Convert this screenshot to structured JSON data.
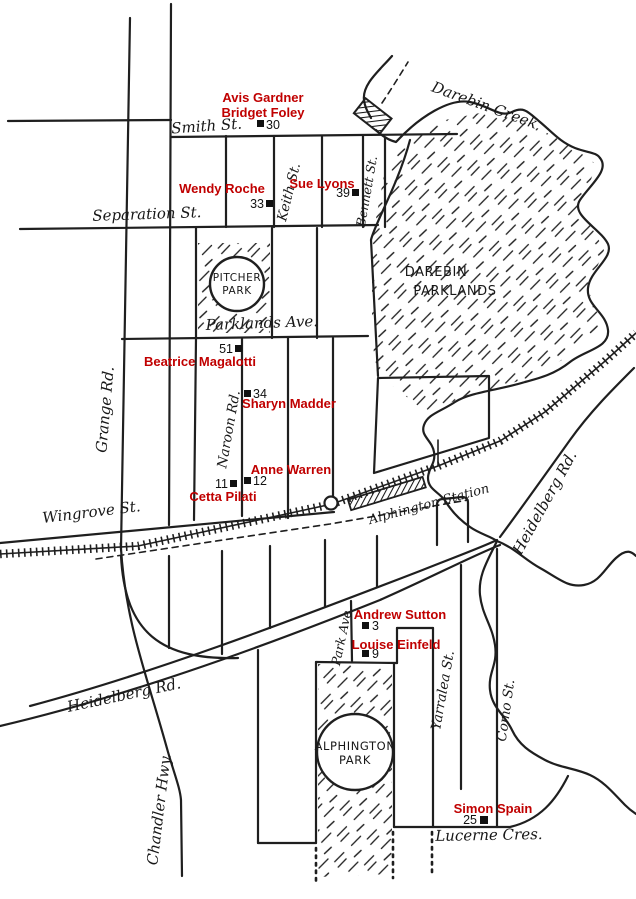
{
  "map_type": "hand-drawn street map",
  "colors": {
    "paper": "#ffffff",
    "ink": "#1f1f1f",
    "resident_label": "#c00000"
  },
  "creek_label": "Darebin Creek",
  "station_label": "Alphington Station",
  "streets": {
    "smith": "Smith St.",
    "separation": "Separation St.",
    "parklands_ave": "Parklands Ave.",
    "wingrove": "Wingrove St.",
    "grange": "Grange Rd.",
    "keith": "Keith St.",
    "bennett": "Bennett St.",
    "naroon": "Naroon Rd.",
    "heidelberg_right": "Heidelberg Rd.",
    "heidelberg_left": "Heidelberg Rd.",
    "chandler": "Chandler Hwy.",
    "park_ave": "Park Ave.",
    "yarralea": "Yarralea St.",
    "como": "Como St.",
    "lucerne": "Lucerne Cres."
  },
  "parks": {
    "pitcher": {
      "line1": "PITCHER",
      "line2": "PARK"
    },
    "darebin": {
      "line1": "DAREBIN",
      "line2": "PARKLANDS"
    },
    "alphington": {
      "line1": "ALPHINGTON",
      "line2": "PARK"
    }
  },
  "residents": [
    {
      "name": "Avis Gardner",
      "number": ""
    },
    {
      "name": "Bridget Foley",
      "number": "30"
    },
    {
      "name": "Wendy Roche",
      "number": "33"
    },
    {
      "name": "Sue Lyons",
      "number": "39"
    },
    {
      "name": "Beatrice Magalotti",
      "number": "51"
    },
    {
      "name": "Sharyn Madder",
      "number": "34"
    },
    {
      "name": "Anne Warren",
      "number": "12"
    },
    {
      "name": "Cetta Pilati",
      "number": "11"
    },
    {
      "name": "Andrew Sutton",
      "number": "3"
    },
    {
      "name": "Louise Einfeld",
      "number": "9"
    },
    {
      "name": "Simon Spain",
      "number": "25"
    }
  ]
}
